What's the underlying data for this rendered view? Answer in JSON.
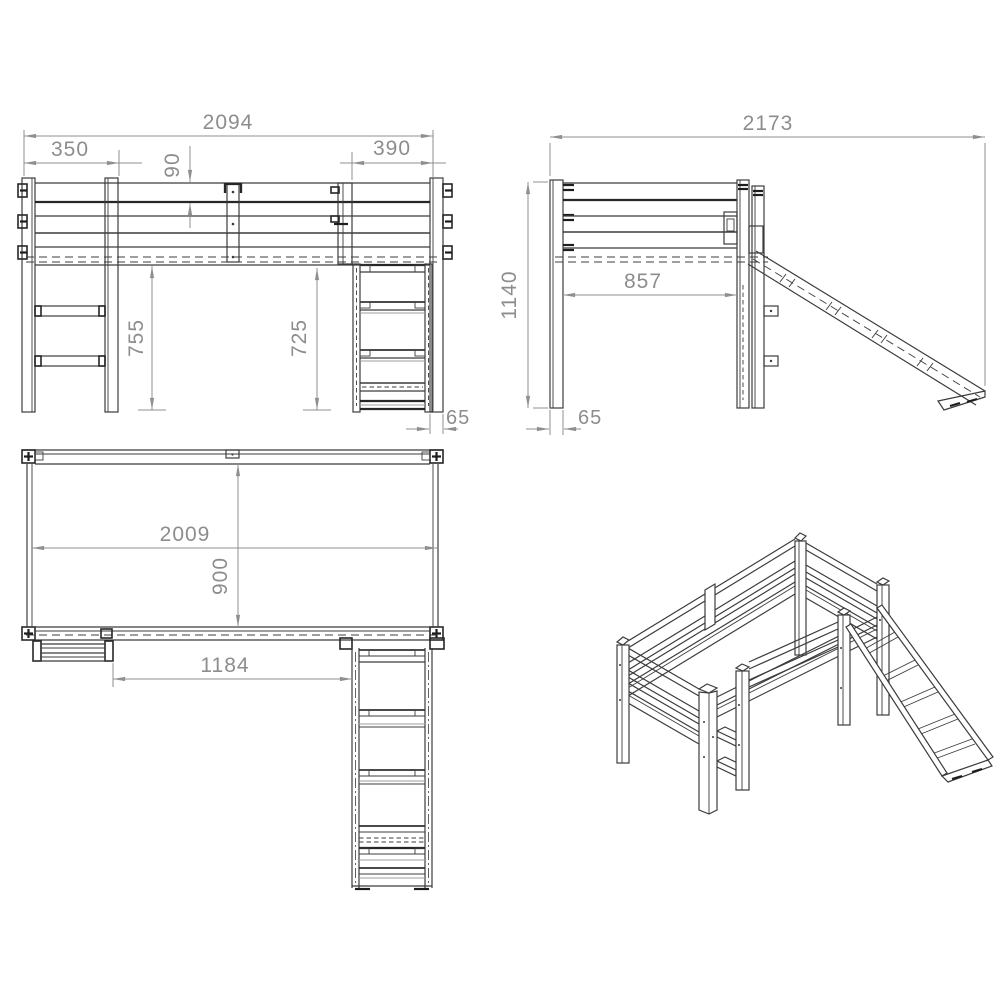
{
  "document": {
    "type": "furniture-assembly-dimension-drawing",
    "subject": "loft bed with slide and ladder",
    "background_color": "#ffffff",
    "line_color": "#3c3c3c",
    "dimension_color": "#8f8f8f"
  },
  "views": {
    "front_elevation": {
      "label": "front-elevation",
      "dims": {
        "overall_width": "2094",
        "ladder_width": "350",
        "board_height": "90",
        "slide_width": "390",
        "underbed_height_left": "755",
        "underbed_height_right": "725",
        "post_depth": "65"
      }
    },
    "side_elevation": {
      "label": "side-elevation",
      "dims": {
        "overall_depth": "2173",
        "overall_height": "1140",
        "clear_inner_depth": "857",
        "post_width": "65"
      }
    },
    "top_plan": {
      "label": "top-plan",
      "dims": {
        "inner_length": "2009",
        "inner_width": "900",
        "slide_offset": "1184"
      }
    },
    "isometric": {
      "label": "isometric-view"
    }
  }
}
